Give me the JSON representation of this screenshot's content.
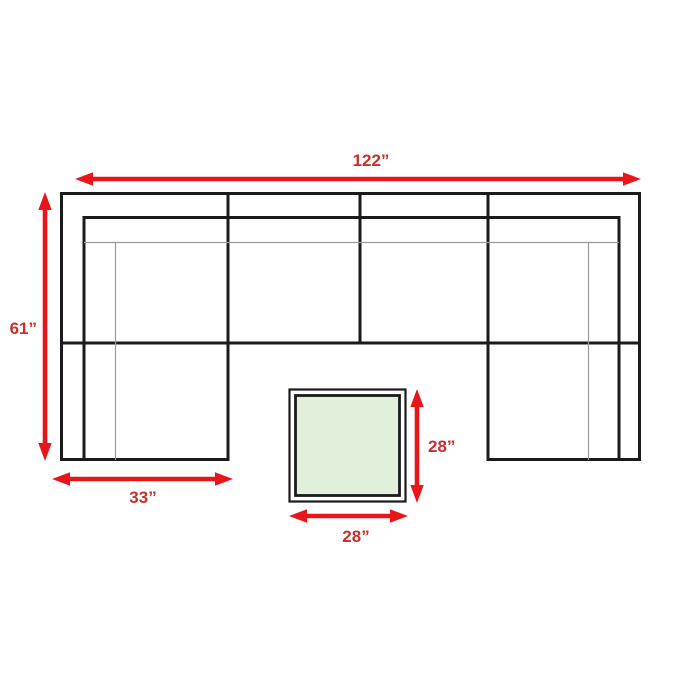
{
  "dimensions": {
    "overall_width": {
      "label": "122”"
    },
    "overall_depth": {
      "label": "61”"
    },
    "chaise_width": {
      "label": "33”"
    },
    "ottoman_depth": {
      "label": "28”"
    },
    "ottoman_width": {
      "label": "28”"
    }
  },
  "icons": {
    "horizontal_double_arrow": "double-headed horizontal dimension arrow",
    "vertical_double_arrow": "double-headed vertical dimension arrow"
  },
  "colors": {
    "arrow": "#e8151b",
    "label_text": "#c9302c",
    "outline": "#1b1b1b",
    "detail_line": "#9a9a9a",
    "ottoman_fill": "#e2efda",
    "background": "#ffffff"
  }
}
